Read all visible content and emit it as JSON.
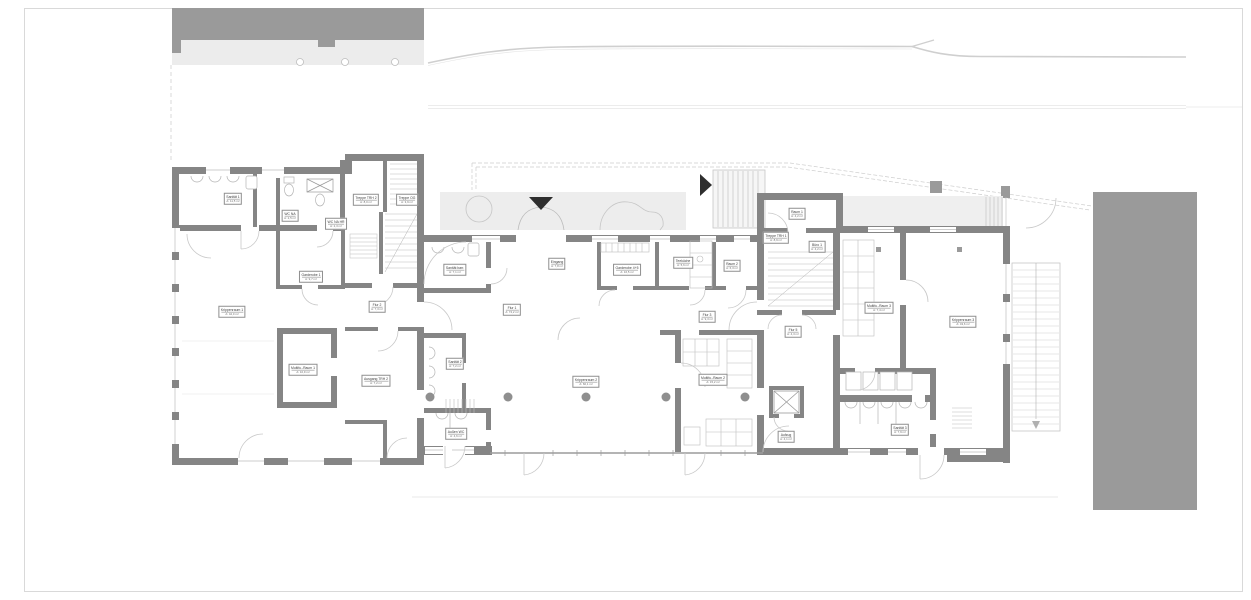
{
  "plan": {
    "drawing_type": "floor-plan",
    "colors": {
      "wall": "#858585",
      "neighbor_building": "#9a9a9a",
      "terrace": "#ededed",
      "thin_line": "#c4c4c4",
      "stair_line": "#bdbdbd",
      "contour_line": "#cfcfcf",
      "label_border": "#8f8f8f",
      "marker": "#2e2e2e",
      "glass_wall": "#9c9c9c",
      "frame": "#d9d9d9"
    },
    "icons": {
      "main_entrance_marker": "triangle-down-filled",
      "side_entrance_marker": "triangle-right-filled",
      "stair_direction_arrow": "triangle-down-small"
    },
    "markers": [
      {
        "id": "main-entrance",
        "shape": "triangle-down",
        "x": 541,
        "y": 203
      },
      {
        "id": "side-entrance",
        "shape": "triangle-right",
        "x": 706,
        "y": 185
      }
    ],
    "rooms": [
      {
        "name": "Sanität 1",
        "area": "A: 11,5 m²",
        "x": 233,
        "y": 199
      },
      {
        "name": "WC NA",
        "area": "A: 2,5 m²",
        "x": 290,
        "y": 216
      },
      {
        "name": "WC NA HR",
        "area": "A: 2,3 m²",
        "x": 336,
        "y": 224
      },
      {
        "name": "Treppe TRH 2",
        "area": "A: 8,0 m²",
        "x": 366,
        "y": 200
      },
      {
        "name": "Treppe OG",
        "area": "A: 3,9 m²",
        "x": 407,
        "y": 200
      },
      {
        "name": "Garderobe 1",
        "area": "A: 9,7 m²",
        "x": 311,
        "y": 277
      },
      {
        "name": "Flur 2",
        "area": "A: 7,3 m²",
        "x": 377,
        "y": 307
      },
      {
        "name": "Krippenraum 1",
        "area": "A: 42,0 m²",
        "x": 232,
        "y": 312
      },
      {
        "name": "Multifu.-Raum 1",
        "area": "A: 10,9 m²",
        "x": 303,
        "y": 370
      },
      {
        "name": "Ausgang TRH 2",
        "area": "A: 7,2 m²",
        "x": 376,
        "y": 381
      },
      {
        "name": "Sanität barr.",
        "area": "A: 7,1 m²",
        "x": 455,
        "y": 270
      },
      {
        "name": "Eingang",
        "area": "A: 7,8 m²",
        "x": 557,
        "y": 264
      },
      {
        "name": "Garderobe 4+5",
        "area": "A: 16,5 m²",
        "x": 627,
        "y": 270
      },
      {
        "name": "Teeküche",
        "area": "A: 5,6 m²",
        "x": 683,
        "y": 263
      },
      {
        "name": "Raum 2",
        "area": "A: 6,3 m²",
        "x": 732,
        "y": 266
      },
      {
        "name": "Flur 1",
        "area": "A: 74,2 m²",
        "x": 512,
        "y": 310
      },
      {
        "name": "Flur 3",
        "area": "A: 9,3 m²",
        "x": 707,
        "y": 317
      },
      {
        "name": "Krippenraum 2",
        "area": "A: 60,1 m²",
        "x": 586,
        "y": 382
      },
      {
        "name": "Multifu.-Raum 2",
        "area": "A: 15,2 m²",
        "x": 713,
        "y": 380
      },
      {
        "name": "Sanität 2",
        "area": "A: 7,2 m²",
        "x": 455,
        "y": 364
      },
      {
        "name": "Außen WC",
        "area": "A: 4,6 m²",
        "x": 456,
        "y": 434
      },
      {
        "name": "Aufzug",
        "area": "A: 4,1 m²",
        "x": 786,
        "y": 437
      },
      {
        "name": "Raum 1",
        "area": "A: 4,2 m²",
        "x": 797,
        "y": 214
      },
      {
        "name": "Treppe TRH 1",
        "area": "A: 8,9 m²",
        "x": 776,
        "y": 238
      },
      {
        "name": "Büro 1",
        "area": "A: 4,2 m²",
        "x": 817,
        "y": 247
      },
      {
        "name": "Flur 5",
        "area": "A: 4,3 m²",
        "x": 793,
        "y": 332
      },
      {
        "name": "Multifu.-Raum 3",
        "area": "A: 7,4 m²",
        "x": 879,
        "y": 308
      },
      {
        "name": "Krippenraum 3",
        "area": "A: 43,6 m²",
        "x": 963,
        "y": 322
      },
      {
        "name": "Sanität 3",
        "area": "A: 7,9 m²",
        "x": 900,
        "y": 430
      }
    ]
  }
}
